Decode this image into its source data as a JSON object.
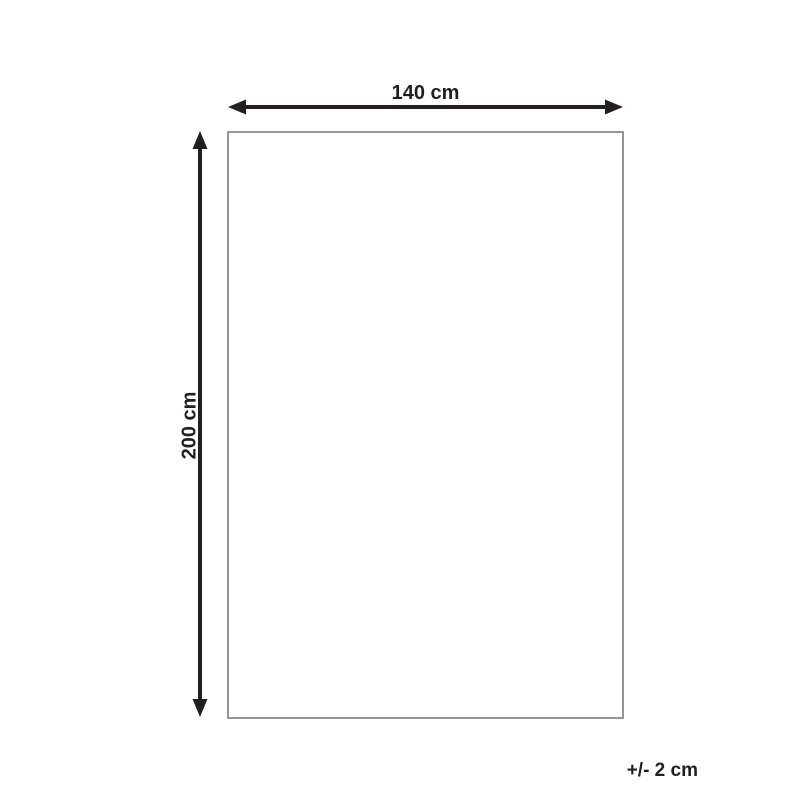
{
  "diagram": {
    "type": "product-dimension-diagram",
    "width_label": "140 cm",
    "height_label": "200 cm",
    "tolerance_label": "+/- 2 cm",
    "colors": {
      "arrow": "#231f20",
      "rect_border": "#939598",
      "background": "#ffffff",
      "text": "#231f20"
    }
  }
}
